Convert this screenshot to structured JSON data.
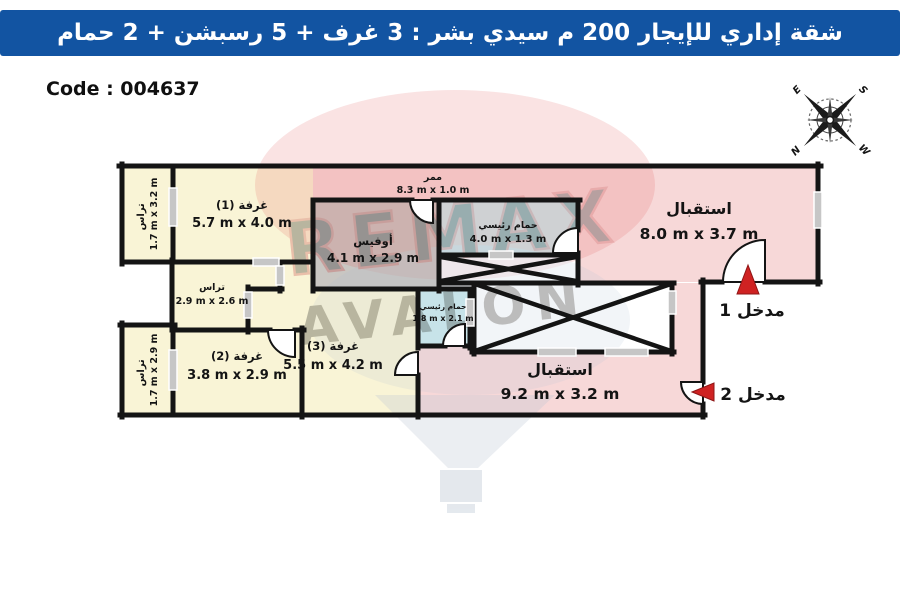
{
  "header": {
    "title": "شقة إداري للإيجار 200 م سيدي بشر : 3 غرف + 5 رسبشن + 2 حمام"
  },
  "code": {
    "label": "Code : 004637"
  },
  "compass": {
    "e": "E",
    "s": "S",
    "n": "N",
    "w": "W"
  },
  "watermark": {
    "brand_top": "REMAX",
    "brand_bottom": "AVALON"
  },
  "rooms": {
    "terrace1": {
      "name": "تراس",
      "dims": "1.7 m x 3.2 m"
    },
    "room1": {
      "name": "غرفة (1)",
      "dims": "5.7 m x 4.0 m"
    },
    "corridor": {
      "name": "ممر",
      "dims": "8.3 m x 1.0 m"
    },
    "office": {
      "name": "أوفيس",
      "dims": "4.1 m x 2.9 m"
    },
    "bath1": {
      "name": "حمام رئيسي",
      "dims": "4.0 m x 1.3 m"
    },
    "reception1": {
      "name": "استقبال",
      "dims": "8.0 m x 3.7 m"
    },
    "terrace2": {
      "name": "تراس",
      "dims": "2.9 m x 2.6 m"
    },
    "terrace3": {
      "name": "تراس",
      "dims": "1.7 m x 2.9 m"
    },
    "room2": {
      "name": "غرفة (2)",
      "dims": "3.8 m x 2.9 m"
    },
    "room3": {
      "name": "غرفة (3)",
      "dims": "5.5 m x 4.2 m"
    },
    "bath2": {
      "name": "حمام رئيسي",
      "dims": "1.8 m x 2.1 m"
    },
    "reception2": {
      "name": "استقبال",
      "dims": "9.2 m x 3.2 m"
    }
  },
  "entrances": {
    "e1": {
      "label": "مدخل 1"
    },
    "e2": {
      "label": "مدخل 2"
    }
  },
  "colors": {
    "header_bar": "#1254a2",
    "wall": "#141414",
    "room_cream": "#f9f4d6",
    "room_pink": "#f7d8d8",
    "room_blue": "#cdeaed",
    "room_gray": "#c9c6c2",
    "arrow_red": "#cf2222"
  }
}
